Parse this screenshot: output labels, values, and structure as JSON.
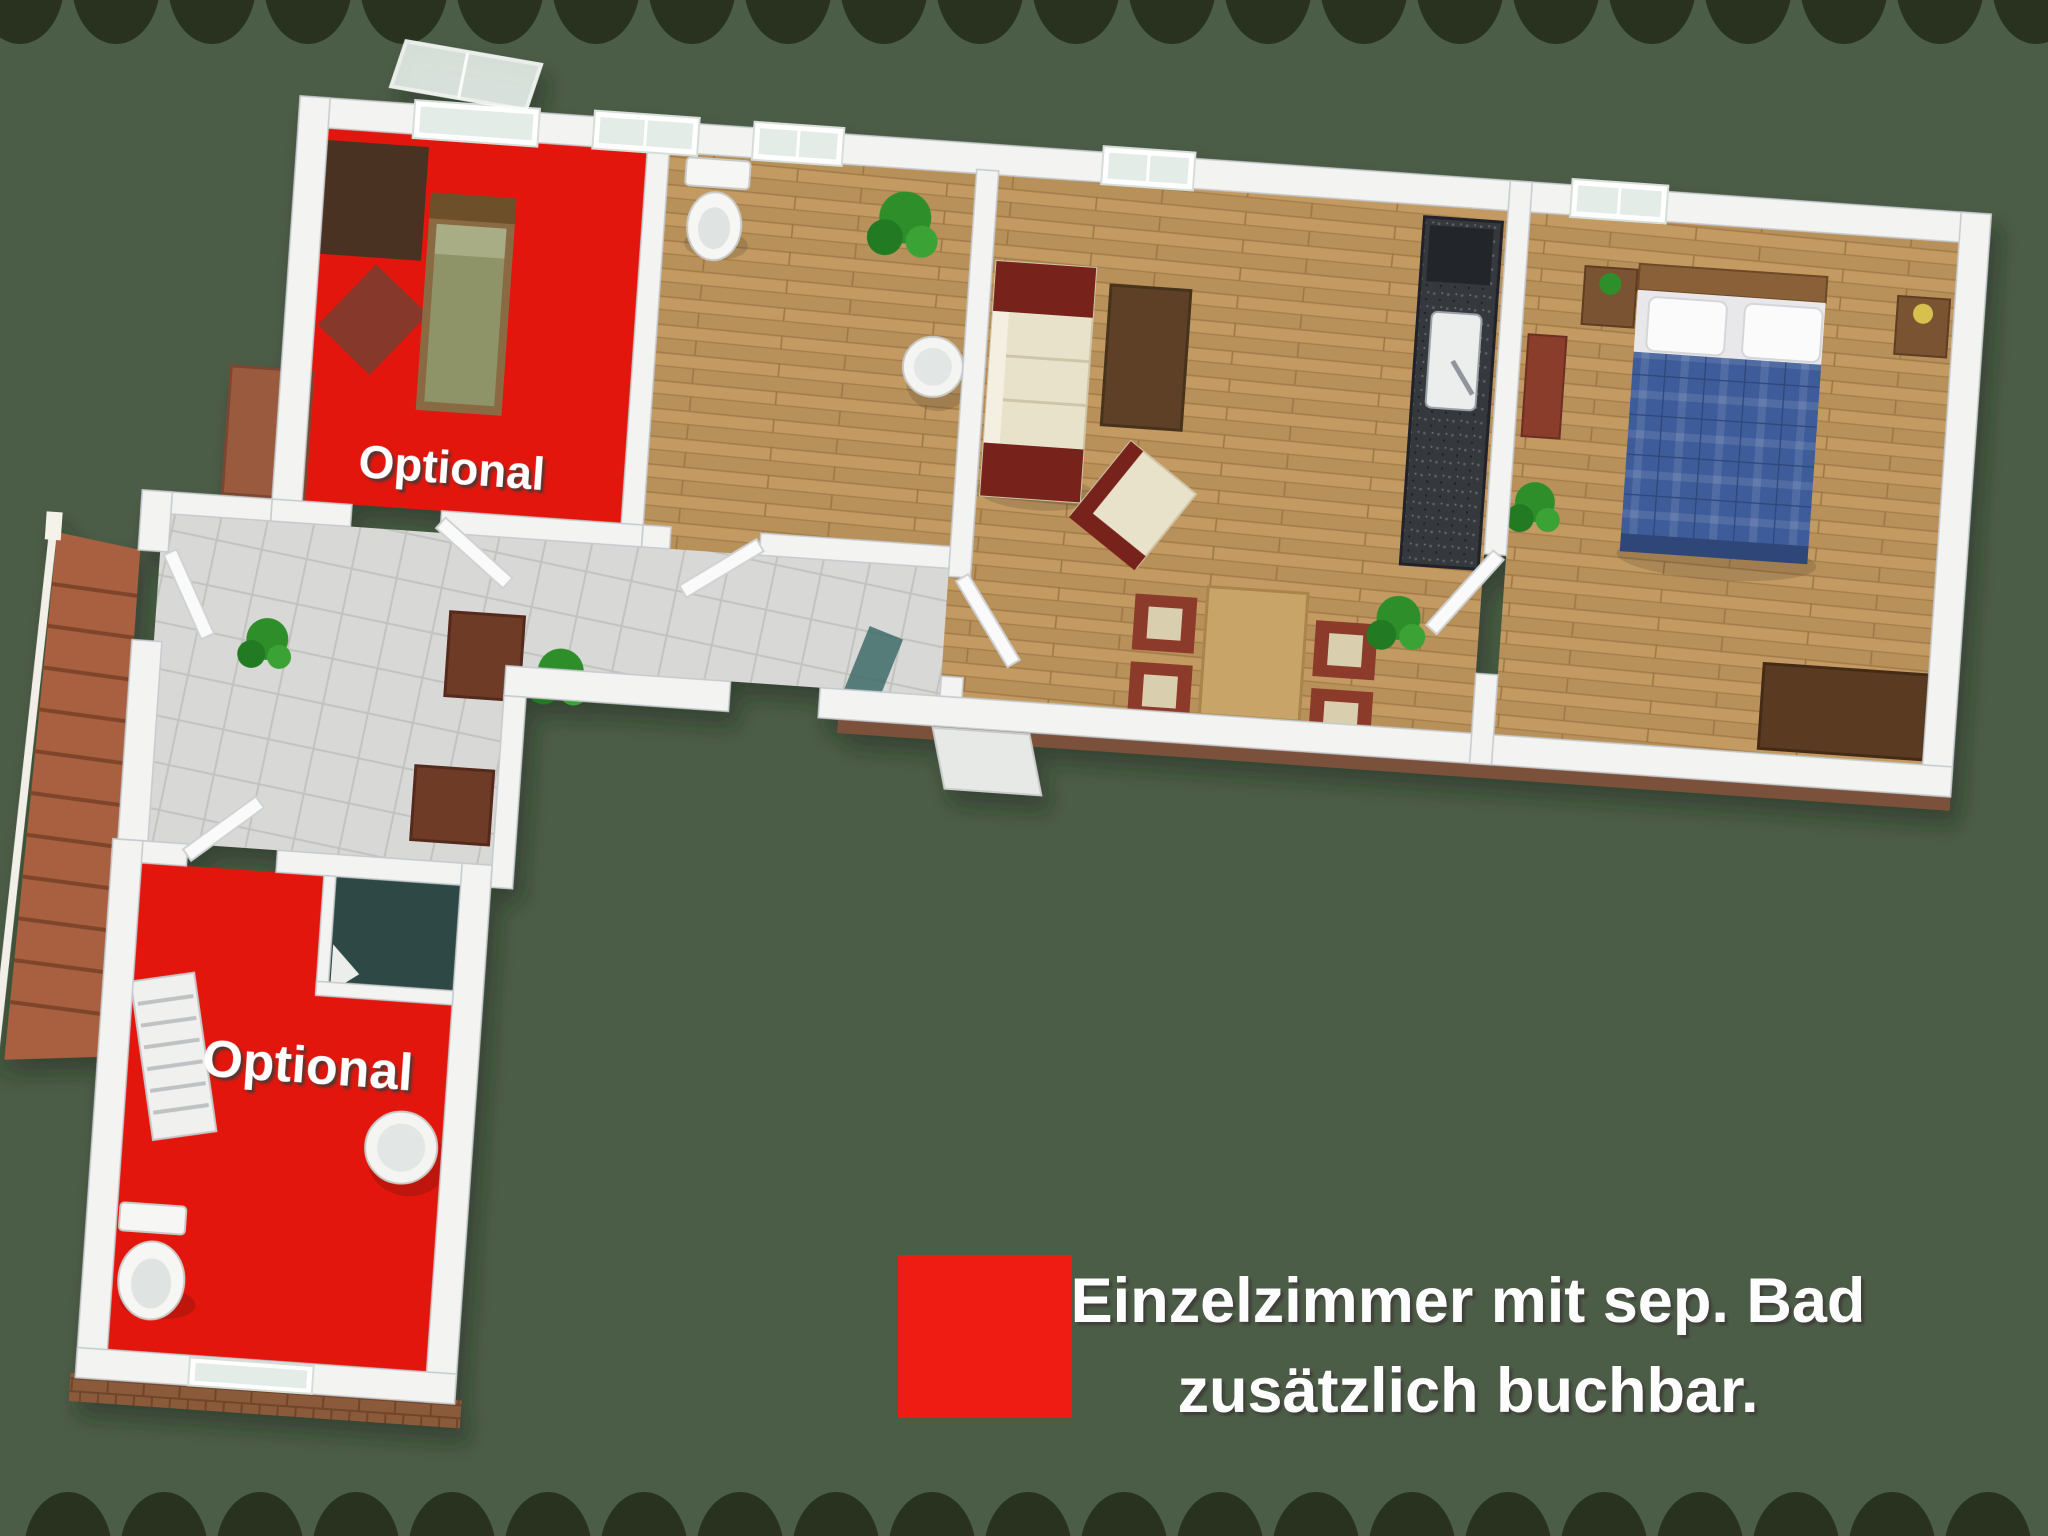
{
  "scene": {
    "background_color": "#4c5d47",
    "border_dot_color": "#29321f"
  },
  "labels": {
    "optional_upper": "Optional",
    "optional_lower": "Optional"
  },
  "legend": {
    "swatch_color": "#ee1c12",
    "line1": "Einzelzimmer mit sep. Bad",
    "line2": "zusätzlich buchbar."
  },
  "palette": {
    "optional_room_red": "#e2170e",
    "wood_floor": "#c29a62",
    "tile_floor": "#d8d9d6",
    "wall_white": "#f3f4f2",
    "bed_blue": "#3d5b99",
    "shower_teal": "#2e4a45",
    "stairs_brick": "#a8613f",
    "sofa_cream": "#e9e2cb",
    "sofa_red": "#78241e"
  }
}
